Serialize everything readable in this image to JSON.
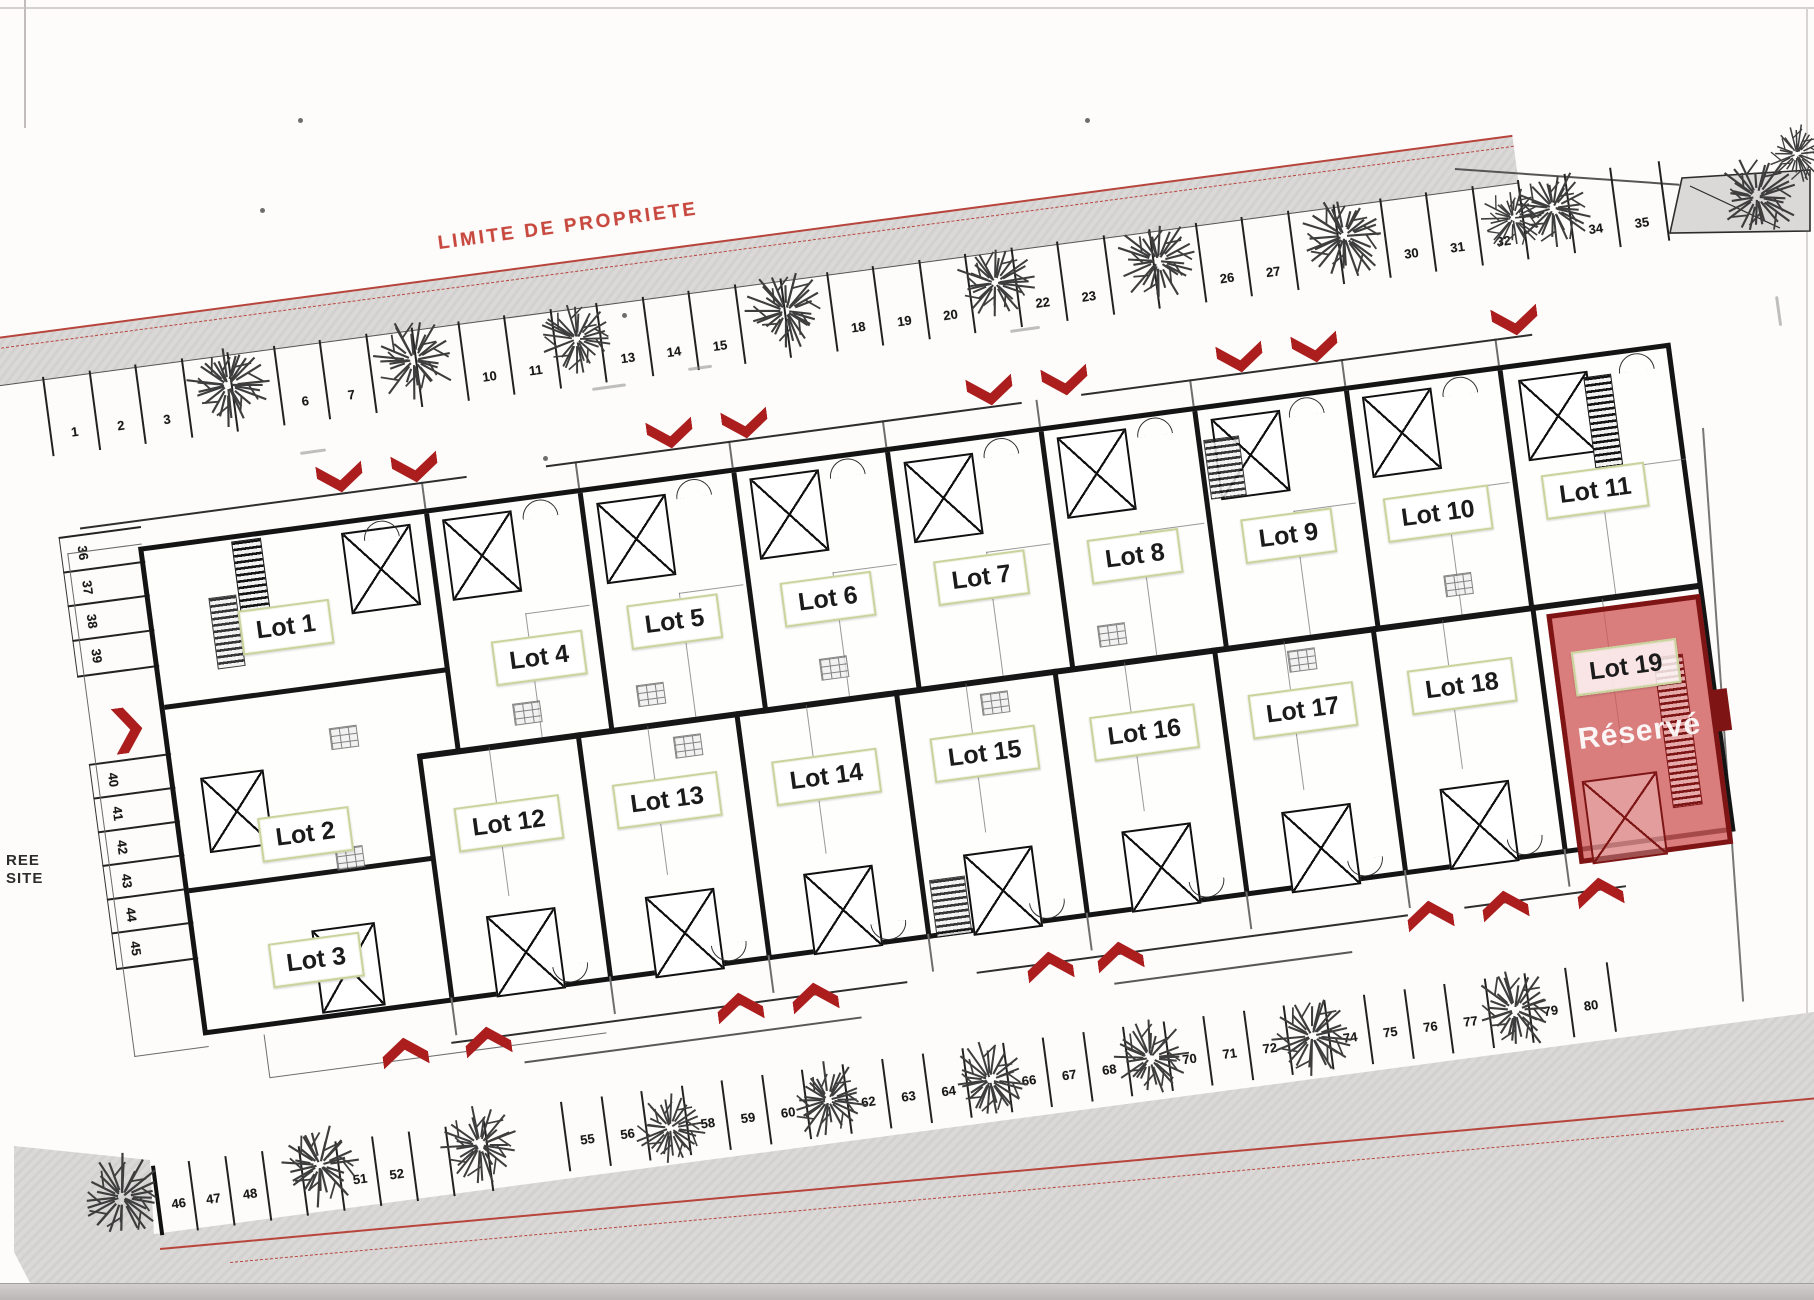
{
  "plan": {
    "texts": {
      "limite_top": "LIMITE DE PROPRIETE",
      "limite_bottom": "LIMITE DE PROPRIETE",
      "entrance_line1": "REE",
      "entrance_line2": "SITE"
    },
    "colors": {
      "boundary_red": "#c33a30",
      "arrow_red": "#ac1e1e",
      "reserved_fill": "#cf5858",
      "reserved_border": "#7e1414",
      "label_border_olive": "#c9d39c",
      "band_gray": "#dbd8d8",
      "wall_black": "#161616"
    },
    "lots": [
      {
        "n": 1,
        "label": "Lot 1",
        "s": 131,
        "y": 94
      },
      {
        "n": 2,
        "label": "Lot 2",
        "s": 123,
        "y": 302
      },
      {
        "n": 3,
        "label": "Lot 3",
        "s": 117,
        "y": 428
      },
      {
        "n": 4,
        "label": "Lot 4",
        "s": 378,
        "y": 158
      },
      {
        "n": 5,
        "label": "Lot 5",
        "s": 517,
        "y": 140
      },
      {
        "n": 6,
        "label": "Lot 6",
        "s": 672,
        "y": 138
      },
      {
        "n": 7,
        "label": "Lot 7",
        "s": 827,
        "y": 137
      },
      {
        "n": 8,
        "label": "Lot 8",
        "s": 982,
        "y": 136
      },
      {
        "n": 9,
        "label": "Lot 9",
        "s": 1137,
        "y": 136
      },
      {
        "n": 10,
        "label": "Lot 10",
        "s": 1288,
        "y": 134
      },
      {
        "n": 11,
        "label": "Lot 11",
        "s": 1447,
        "y": 132
      },
      {
        "n": 12,
        "label": "Lot 12",
        "s": 326,
        "y": 318
      },
      {
        "n": 13,
        "label": "Lot 13",
        "s": 486,
        "y": 316
      },
      {
        "n": 14,
        "label": "Lot 14",
        "s": 647,
        "y": 314
      },
      {
        "n": 15,
        "label": "Lot 15",
        "s": 807,
        "y": 312
      },
      {
        "n": 16,
        "label": "Lot 16",
        "s": 968,
        "y": 312
      },
      {
        "n": 17,
        "label": "Lot 17",
        "s": 1128,
        "y": 311
      },
      {
        "n": 18,
        "label": "Lot 18",
        "s": 1289,
        "y": 308
      },
      {
        "n": 19,
        "label": "Lot 19",
        "s": 1449,
        "y": 306,
        "reserved": true,
        "status_label": "Réservé"
      }
    ],
    "parking": {
      "top_row_numbers": [
        1,
        2,
        3,
        4,
        5,
        6,
        7,
        8,
        9,
        10,
        11,
        12,
        13,
        14,
        15,
        16,
        17,
        18,
        19,
        20,
        21,
        22,
        23,
        24,
        25,
        26,
        27,
        28,
        29,
        30,
        31,
        32,
        33,
        34,
        35
      ],
      "top_row_hidden_by_trees": [
        4,
        5,
        8,
        9,
        12,
        16,
        17,
        21,
        24,
        25,
        28,
        29,
        33
      ],
      "left_column_numbers": [
        36,
        37,
        38,
        39,
        40,
        41,
        42,
        43,
        44,
        45
      ],
      "bottom_row_numbers": [
        46,
        47,
        48,
        49,
        50,
        51,
        52,
        53,
        54,
        55,
        56,
        57,
        58,
        59,
        60,
        61,
        62,
        63,
        64,
        65,
        66,
        67,
        68,
        69,
        70,
        71,
        72,
        73,
        74,
        75,
        76,
        77,
        78,
        79,
        80
      ],
      "bottom_row_hidden_by_trees": [
        49,
        50,
        53,
        54,
        57,
        61,
        65,
        69,
        73,
        78
      ]
    },
    "geometry": {
      "angle": -7.6,
      "building": {
        "x": 138,
        "y": 547,
        "w": 1546,
        "h": 493,
        "midY": 237,
        "topWalls": [
          285,
          440,
          595,
          750,
          905,
          1060,
          1213,
          1368
        ],
        "bottomWalls": [
          246,
          406,
          566,
          727,
          887,
          1048,
          1208,
          1369
        ],
        "leftWalls": [
          {
            "y": 155,
            "len": 285
          },
          {
            "y": 340,
            "len": 246
          }
        ]
      },
      "redZone": {
        "s": 1382,
        "y": 248,
        "w": 155,
        "h": 252,
        "labelRel": [
          67,
          58
        ],
        "statusRel": [
          72,
          124
        ],
        "notchRel": [
          148,
          92,
          16,
          42
        ],
        "xboxRel": [
          8,
          165,
          72,
          80
        ],
        "ladderRel": [
          95,
          52,
          28,
          150
        ]
      },
      "topBand": {
        "x": -40,
        "y": 342,
        "w": 1566,
        "h": 46
      },
      "parkingTop": {
        "x0": 42,
        "y0": 377,
        "start": 1,
        "count": 35,
        "dx": 46.5,
        "h": 80,
        "numY": 52
      },
      "parkingBottomA": {
        "x0": 151,
        "y0": 1166,
        "start": 46,
        "count": 9,
        "dx": 37,
        "h": 70,
        "numY": 34
      },
      "parkingBottomB": {
        "x0": 560,
        "y0": 1102,
        "start": 55,
        "count": 26,
        "dx": 40.5,
        "h": 70,
        "numY": 34
      },
      "parkingLeft": {
        "x": 58,
        "y": 533,
        "w": 82,
        "groups": [
          {
            "startY": 4,
            "h": 34.5,
            "nums": [
              36,
              37,
              38,
              39
            ]
          },
          {
            "startY": 233,
            "h": 34,
            "nums": [
              40,
              41,
              42,
              43,
              44,
              45
            ]
          }
        ]
      },
      "wedge": [
        [
          14,
          1146
        ],
        [
          150,
          1160
        ],
        [
          154,
          1234
        ],
        [
          1814,
          1012
        ],
        [
          1814,
          1283
        ],
        [
          30,
          1283
        ],
        [
          14,
          1252
        ]
      ],
      "redLinesBottom": [
        {
          "x": 160,
          "y": 1248,
          "w": 1680,
          "rot": -5.2,
          "dashed": false
        },
        {
          "x": 230,
          "y": 1262,
          "w": 1560,
          "rot": -5.2,
          "dashed": true
        }
      ],
      "arrowsDown": [
        [
          340,
          478
        ],
        [
          415,
          468
        ],
        [
          670,
          434
        ],
        [
          745,
          424
        ],
        [
          990,
          391
        ],
        [
          1065,
          381
        ],
        [
          1240,
          358
        ],
        [
          1315,
          348
        ],
        [
          1515,
          321
        ]
      ],
      "arrowsUp": [
        [
          405,
          1052
        ],
        [
          488,
          1041
        ],
        [
          740,
          1007
        ],
        [
          815,
          997
        ],
        [
          1050,
          966
        ],
        [
          1120,
          956
        ],
        [
          1430,
          915
        ],
        [
          1505,
          905
        ],
        [
          1600,
          892
        ]
      ],
      "arrowsRight": [
        [
          128,
          730
        ]
      ],
      "trees": [
        [
          228,
          385,
          45
        ],
        [
          414,
          360,
          44
        ],
        [
          577,
          339,
          40
        ],
        [
          786,
          311,
          44
        ],
        [
          995,
          283,
          42
        ],
        [
          1158,
          261,
          44
        ],
        [
          1344,
          236,
          45
        ],
        [
          1553,
          208,
          42
        ],
        [
          1513,
          218,
          34
        ],
        [
          1757,
          197,
          45
        ],
        [
          1797,
          154,
          32
        ],
        [
          122,
          1197,
          46
        ],
        [
          320,
          1165,
          45
        ],
        [
          480,
          1145,
          42
        ],
        [
          670,
          1128,
          40
        ],
        [
          828,
          1100,
          42
        ],
        [
          990,
          1080,
          42
        ],
        [
          1150,
          1058,
          42
        ],
        [
          1312,
          1036,
          43
        ],
        [
          1515,
          1010,
          44
        ]
      ],
      "xboxesTop": [
        [
          198,
          8
        ],
        [
          300,
          8
        ],
        [
          455,
          12
        ],
        [
          610,
          8
        ],
        [
          765,
          12
        ],
        [
          920,
          8
        ],
        [
          1075,
          10
        ],
        [
          1228,
          8
        ],
        [
          1385,
          12
        ]
      ],
      "xboxesBottom": [
        [
          291,
          407
        ],
        [
          451,
          409
        ],
        [
          611,
          407
        ],
        [
          772,
          409
        ],
        [
          932,
          407
        ],
        [
          1093,
          409
        ],
        [
          1253,
          407
        ]
      ],
      "xboxesMisc": [
        [
          26,
          232,
          60,
          72
        ],
        [
          116,
          398,
          60,
          80
        ]
      ],
      "ladders": [
        [
          88,
          2,
          28,
          92
        ],
        [
          1450,
          18,
          26,
          108
        ]
      ],
      "darkClusters": [
        [
          1065,
          30,
          34,
          58
        ],
        [
          735,
          430,
          34,
          56
        ],
        [
          58,
          55,
          26,
          70
        ]
      ],
      "fixtures": [
        [
          160,
          200
        ],
        [
          345,
          200
        ],
        [
          470,
          198
        ],
        [
          655,
          196
        ],
        [
          810,
          252
        ],
        [
          935,
          200
        ],
        [
          1120,
          250
        ],
        [
          500,
          254
        ],
        [
          1285,
          196
        ],
        [
          150,
          320
        ]
      ],
      "arcsTop": [
        220,
        380,
        535,
        690,
        845,
        1000,
        1153,
        1308,
        1486
      ],
      "arcsBottom": [
        350,
        510,
        671,
        831,
        992,
        1152,
        1313
      ],
      "roadLinesTopY": -32,
      "roadLinesTop": [
        [
          -60,
          330
        ],
        [
          410,
          890
        ],
        [
          950,
          1405
        ]
      ],
      "roadLinesBot1": {
        "y": 527,
        "segs": [
          [
            240,
            700
          ],
          [
            770,
            1205
          ],
          [
            1262,
            1425
          ]
        ]
      },
      "roadLinesBot2": {
        "y": 556,
        "segs": [
          [
            310,
            650
          ],
          [
            905,
            1145
          ]
        ]
      },
      "gardenBottomLine": {
        "y": 538,
        "segs": [
          [
            55,
            395
          ]
        ]
      },
      "trapezoid": {
        "x": 1662,
        "y": 160,
        "pts": [
          [
            8,
            73
          ],
          [
            20,
            18
          ],
          [
            148,
            10
          ],
          [
            148,
            71
          ]
        ],
        "inner": [
          [
            28,
            26
          ],
          [
            118,
            68
          ]
        ]
      },
      "rightBoundary": {
        "x": 1702,
        "y": 428,
        "h": 575,
        "rot": -4
      },
      "connector": {
        "x": 1455,
        "y": 168,
        "w": 225,
        "rot": 4
      },
      "specks": [
        [
          622,
          313
        ],
        [
          543,
          456
        ],
        [
          298,
          118
        ],
        [
          1085,
          118
        ],
        [
          260,
          208
        ]
      ],
      "smudges": [
        [
          592,
          388,
          -8,
          34
        ],
        [
          1010,
          330,
          -8,
          30
        ],
        [
          300,
          452,
          -8,
          26
        ],
        [
          1778,
          296,
          82,
          30
        ],
        [
          688,
          368,
          -8,
          24
        ]
      ]
    }
  }
}
